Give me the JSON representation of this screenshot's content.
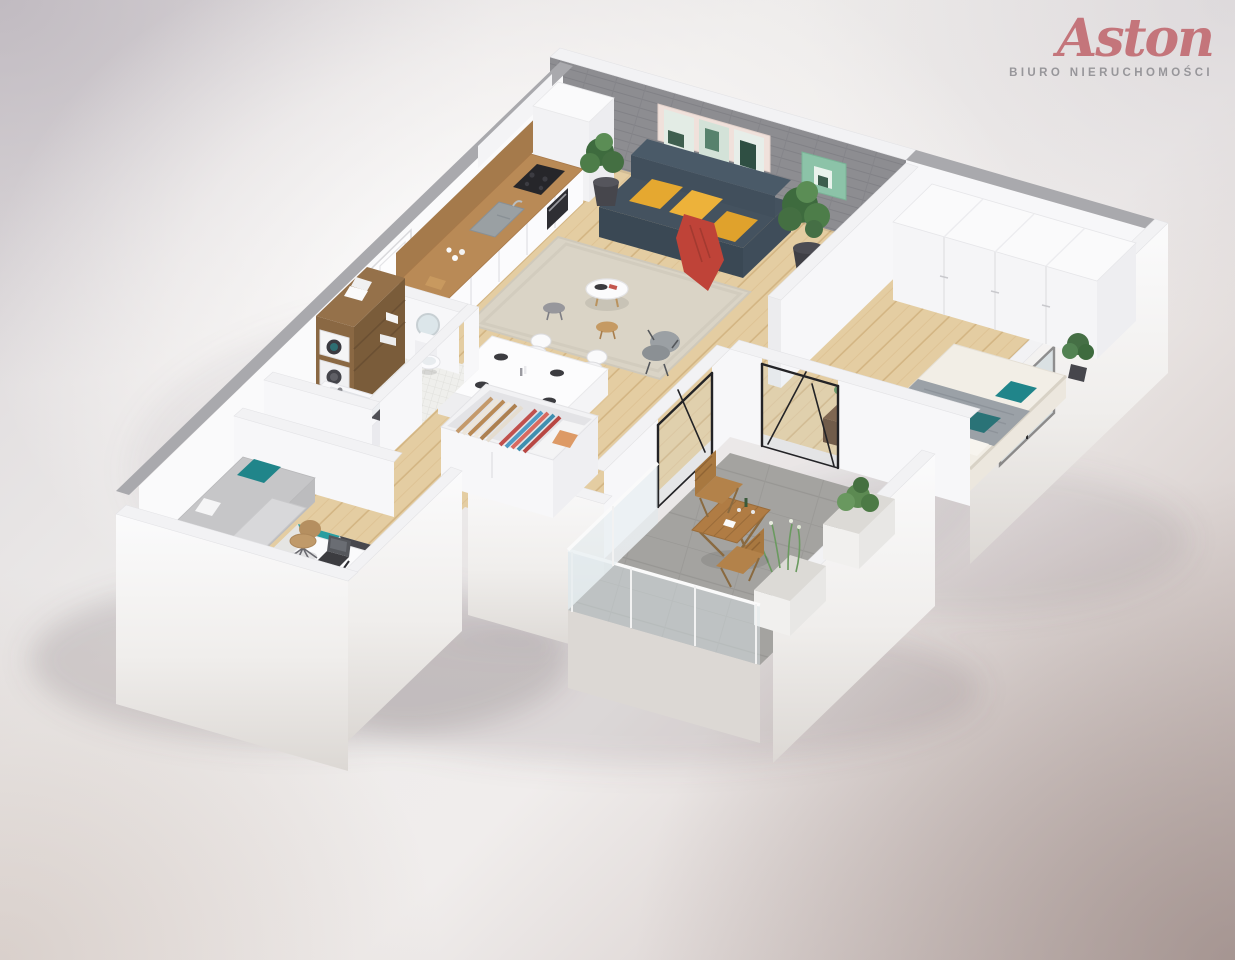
{
  "brand": {
    "name": "Aston",
    "tagline": "BIURO NIERUCHOMOŚCI"
  },
  "colors": {
    "brand": "#c4757b",
    "tagline": "#97969a",
    "background_mauve": "#b3a7a5",
    "wall_white": "#f7f7f9",
    "wall_cap_gray": "#a9a9ad",
    "brick_accent_wall": "#8d8d91",
    "floor_wood": "#e3cca0",
    "balcony_concrete": "#a4a3a0",
    "sofa_navy": "#44525f",
    "cushion_yellow": "#e5a830",
    "throw_red": "#bf4338",
    "accent_teal": "#20858a",
    "rug_beige": "#dad4c6",
    "bathroom_tile": "#ededea",
    "wood_furniture": "#b07c44",
    "wardrobe_wood": "#8a6843"
  },
  "scene": {
    "type": "isometric-3d-apartment-floor-plan-render",
    "rooms": [
      {
        "name": "living-room",
        "furniture": [
          "navy sofa with three yellow cushions and red throw",
          "two potted plants in dark pots",
          "beige shaggy rug",
          "round white coffee table with dark tray",
          "gray stool",
          "wooden stool",
          "gray armchair",
          "triple framed wall art",
          "green wall art",
          "gray brick accent wall"
        ]
      },
      {
        "name": "kitchen",
        "furniture": [
          "white cabinet run with wood countertop",
          "black cooktop",
          "built-in oven",
          "gray double sink",
          "cups",
          "wooden cutting board",
          "tall white cabinet",
          "wood backsplash shelf"
        ]
      },
      {
        "name": "dining-area",
        "furniture": [
          "white dining table",
          "four white shell chairs",
          "four dark place settings",
          "candlestick"
        ]
      },
      {
        "name": "hallway",
        "furniture": [
          "white entrance door with handle",
          "open-top wardrobe with hanging clothes (tan, red, blue) and shelf with folded item"
        ]
      },
      {
        "name": "bedroom",
        "furniture": [
          "full-width white wardrobe",
          "double bed with white duvet, gray folded blanket and teal pillows",
          "dark wood nightstand with plant",
          "corner potted plant",
          "black framed glass balcony door",
          "window"
        ]
      },
      {
        "name": "balcony",
        "furniture": [
          "wooden folding bistro table",
          "two wooden folding chairs",
          "white planter boxes with greenery",
          "glass balustrade",
          "concrete tile floor"
        ]
      },
      {
        "name": "bathroom",
        "furniture": [
          "wooden column with washer and dryer and towels",
          "white toilet",
          "round mirror",
          "bathtub",
          "dark bath mat",
          "white mosaic tile floor"
        ]
      },
      {
        "name": "office",
        "furniture": [
          "gray daybed with teal and white pillows",
          "teal geometric rug",
          "white corner desk with laptop, lamp, phone and notebook",
          "tan shell desk chair"
        ]
      }
    ]
  }
}
